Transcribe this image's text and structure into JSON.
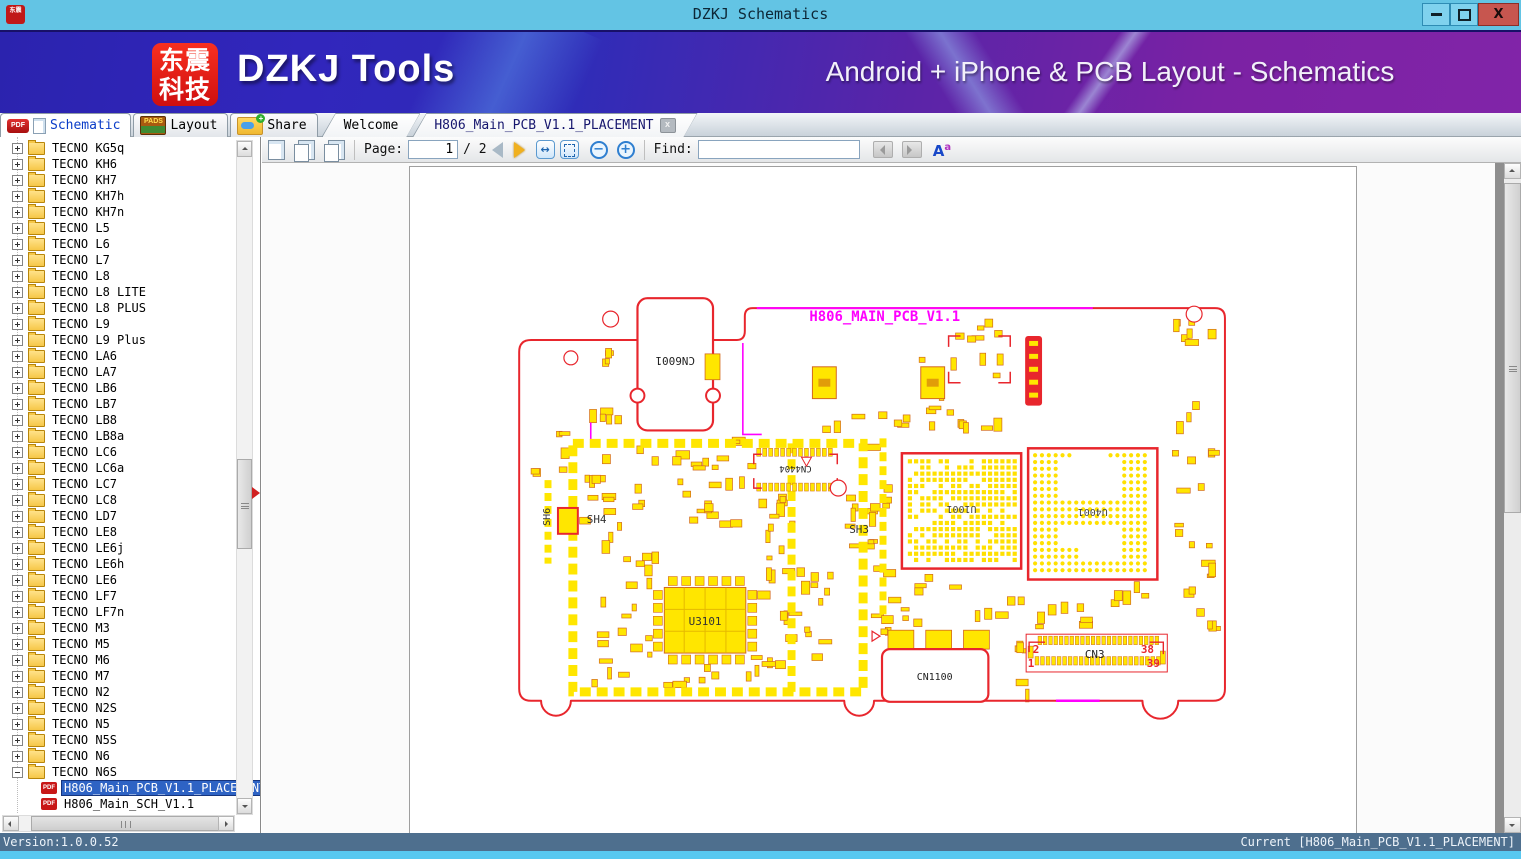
{
  "window": {
    "title": "DZKJ Schematics",
    "close_glyph": "X"
  },
  "banner": {
    "logo_line1": "东震",
    "logo_line2": "科技",
    "app_name": "DZKJ Tools",
    "tagline": "Android + iPhone & PCB Layout - Schematics"
  },
  "icons": {
    "pdf_label": "PDF",
    "pads_label": "PADS",
    "share_plus": "+",
    "close_x": "x"
  },
  "tabs": {
    "main": [
      {
        "label": "Schematic",
        "active": true
      },
      {
        "label": "Layout",
        "active": false
      },
      {
        "label": "Share",
        "active": false
      }
    ],
    "documents": [
      {
        "label": "Welcome",
        "active": false
      },
      {
        "label": "H806_Main_PCB_V1.1_PLACEMENT",
        "active": true,
        "closable": true
      }
    ]
  },
  "toolbar": {
    "page_label": "Page:",
    "page_value": "1",
    "page_total": "/ 2",
    "zoom_out": "−",
    "zoom_in": "+",
    "fit_width_glyph": "↔",
    "find_label": "Find:",
    "find_value": "",
    "case_a": "A",
    "case_sup": "a"
  },
  "sidebar": {
    "folders": [
      "TECNO KG5q",
      "TECNO KH6",
      "TECNO KH7",
      "TECNO KH7h",
      "TECNO KH7n",
      "TECNO L5",
      "TECNO L6",
      "TECNO L7",
      "TECNO L8",
      "TECNO L8 LITE",
      "TECNO L8 PLUS",
      "TECNO L9",
      "TECNO L9 Plus",
      "TECNO LA6",
      "TECNO LA7",
      "TECNO LB6",
      "TECNO LB7",
      "TECNO LB8",
      "TECNO LB8a",
      "TECNO LC6",
      "TECNO LC6a",
      "TECNO LC7",
      "TECNO LC8",
      "TECNO LD7",
      "TECNO LE8",
      "TECNO LE6j",
      "TECNO LE6h",
      "TECNO LE6",
      "TECNO LF7",
      "TECNO LF7n",
      "TECNO M3",
      "TECNO M5",
      "TECNO M6",
      "TECNO M7",
      "TECNO N2",
      "TECNO N2S",
      "TECNO N5",
      "TECNO N5S",
      "TECNO N6",
      "TECNO N6S"
    ],
    "expanded_folder": "TECNO N6S",
    "files": [
      {
        "label": "H806_Main_PCB_V1.1_PLACEMENT",
        "selected": true
      },
      {
        "label": "H806_Main_SCH_V1.1",
        "selected": false
      }
    ]
  },
  "pcb": {
    "board_title": "H806_MAIN_PCB_V1.1",
    "refs": {
      "cn6001": "CN6001",
      "cn4404": "CN4404",
      "u1001": "U1001",
      "u4001": "U4001",
      "u3101": "U3101",
      "cn1100": "CN1100",
      "cn3": "CN3",
      "sh3": "SH3",
      "sh4": "SH4",
      "sh6": "SH6"
    },
    "cn3_pins": {
      "p2": "2",
      "p1": "1",
      "p38": "38",
      "p39": "39"
    },
    "colors": {
      "board_outline": "#e8262d",
      "component_fill": "#ffe600",
      "component_border": "#d2691e",
      "silkscreen_accent": "#ff00ff"
    }
  },
  "statusbar": {
    "version": "Version:1.0.0.52",
    "current": "Current [H806_Main_PCB_V1.1_PLACEMENT]"
  }
}
